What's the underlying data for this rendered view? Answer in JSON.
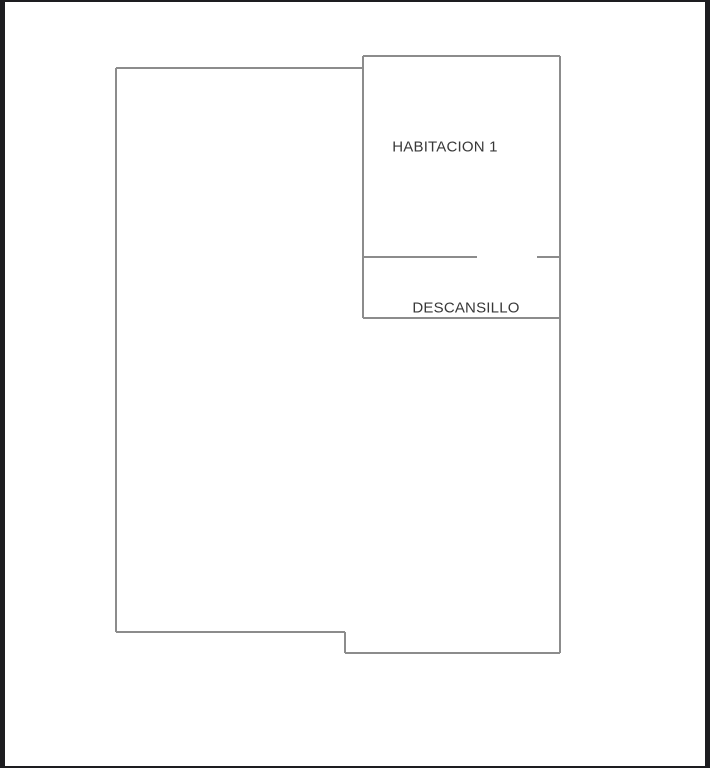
{
  "frame": {
    "border_color": "#1d1d20",
    "canvas_color": "#ffffff"
  },
  "floor_plan": {
    "wall_color": "#8c8c8c",
    "wall_thickness": 2,
    "text_color": "#383838",
    "walls": [
      {
        "name": "big-room-top-wall",
        "x1": 116,
        "y1": 68,
        "x2": 363,
        "y2": 68
      },
      {
        "name": "big-room-left-wall",
        "x1": 116,
        "y1": 68,
        "x2": 116,
        "y2": 632
      },
      {
        "name": "big-room-bottom-wall",
        "x1": 116,
        "y1": 632,
        "x2": 345,
        "y2": 632
      },
      {
        "name": "bottom-step-wall",
        "x1": 345,
        "y1": 632,
        "x2": 345,
        "y2": 653
      },
      {
        "name": "bottom-right-wall",
        "x1": 345,
        "y1": 653,
        "x2": 560,
        "y2": 653
      },
      {
        "name": "right-wall",
        "x1": 560,
        "y1": 56,
        "x2": 560,
        "y2": 653
      },
      {
        "name": "habitacion-top-wall",
        "x1": 363,
        "y1": 56,
        "x2": 560,
        "y2": 56
      },
      {
        "name": "habitacion-left-wall",
        "x1": 363,
        "y1": 56,
        "x2": 363,
        "y2": 318
      },
      {
        "name": "divider-wall-left-of-door",
        "x1": 363,
        "y1": 257,
        "x2": 477,
        "y2": 257
      },
      {
        "name": "divider-wall-right-of-door",
        "x1": 537,
        "y1": 257,
        "x2": 560,
        "y2": 257
      },
      {
        "name": "descansillo-bottom-wall",
        "x1": 363,
        "y1": 318,
        "x2": 560,
        "y2": 318
      }
    ],
    "rooms": [
      {
        "id": "habitacion-1",
        "label": "HABITACION 1",
        "label_x": 445,
        "label_y": 147
      },
      {
        "id": "descansillo",
        "label": "DESCANSILLO",
        "label_x": 466,
        "label_y": 308
      }
    ]
  }
}
